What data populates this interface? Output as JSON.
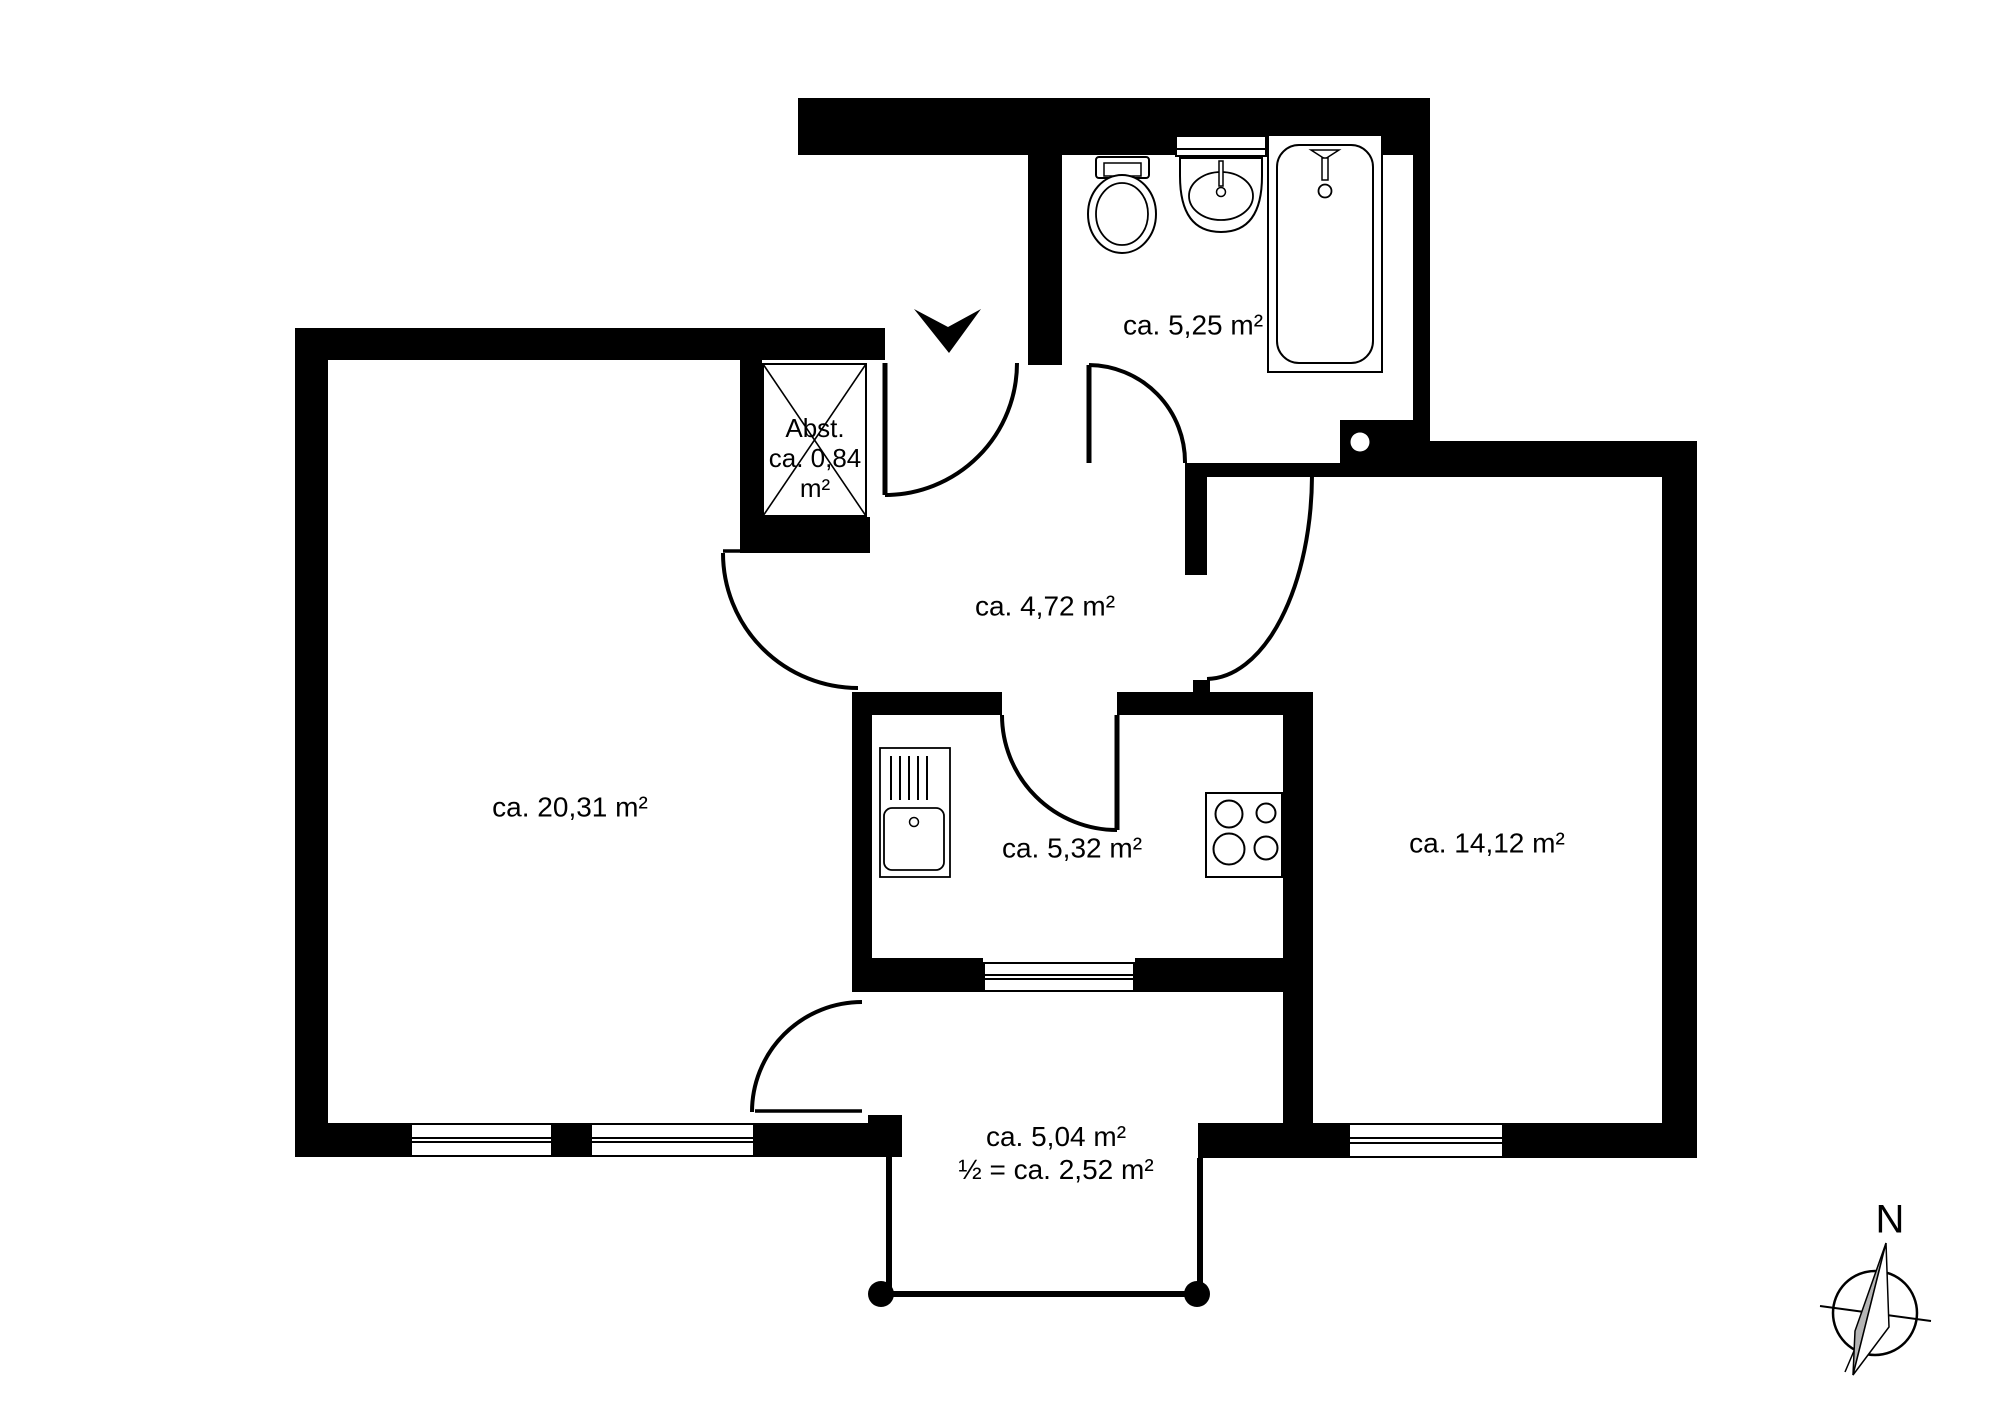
{
  "rooms": {
    "storage": {
      "name": "Abst.",
      "area": "ca. 0,84",
      "unit": "m²"
    },
    "bathroom": {
      "area": "ca. 5,25 m²"
    },
    "hallway": {
      "area": "ca. 4,72 m²"
    },
    "living_room": {
      "area": "ca. 20,31 m²"
    },
    "kitchen": {
      "area": "ca. 5,32 m²"
    },
    "bedroom": {
      "area": "ca. 14,12 m²"
    },
    "balcony": {
      "area": "ca. 5,04 m²",
      "half_area": "½ = ca. 2,52 m²"
    }
  },
  "compass": {
    "north": "N"
  },
  "colors": {
    "wall": "#000000",
    "background": "#ffffff",
    "compass_needle": "#b5b5b5"
  }
}
